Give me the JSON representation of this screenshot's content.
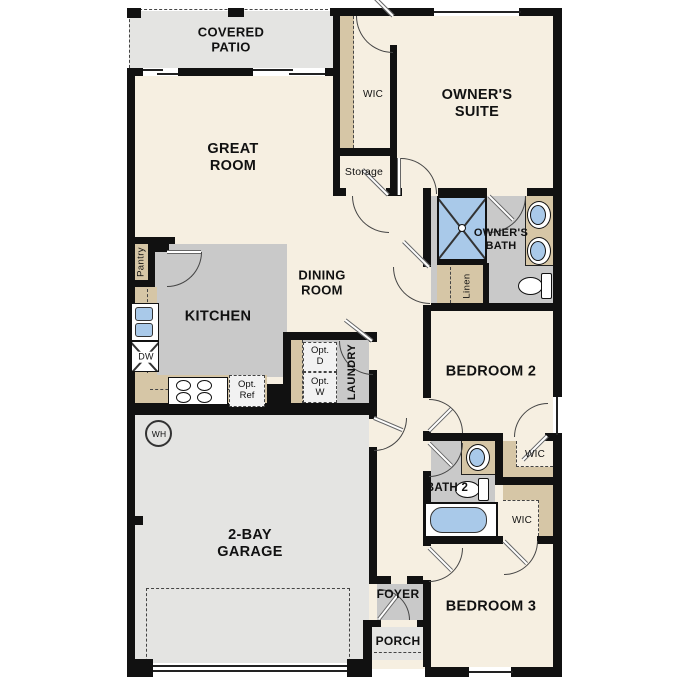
{
  "title": "Single-story floor plan",
  "colors": {
    "floor_cream": "#f6efe1",
    "floor_gray": "#c9c9c9",
    "floor_light": "#e4e4e2",
    "casework_tan": "#d6c6a6",
    "fixture_blue": "#a9c9e9",
    "wall": "#111111",
    "text": "#111111"
  },
  "rooms": {
    "covered_patio": "COVERED PATIO",
    "great_room": "GREAT ROOM",
    "owners_suite": "OWNER'S SUITE",
    "wic_owner": "WIC",
    "storage": "Storage",
    "dining_room": "DINING ROOM",
    "kitchen": "KITCHEN",
    "pantry": "Pantry",
    "owners_bath": "OWNER'S BATH",
    "linen": "Linen",
    "laundry": "LAUNDRY",
    "bedroom2": "BEDROOM 2",
    "wic_bedroom2": "WIC",
    "bath2": "BATH 2",
    "wic_bedroom3": "WIC",
    "bedroom3": "BEDROOM 3",
    "garage": "2-BAY GARAGE",
    "foyer": "FOYER",
    "porch": "PORCH"
  },
  "fixtures": {
    "dishwasher": "DW",
    "water_heater": "WH",
    "opt_dryer": {
      "l1": "Opt.",
      "l2": "D"
    },
    "opt_washer": {
      "l1": "Opt.",
      "l2": "W"
    },
    "opt_refrigerator": {
      "l1": "Opt.",
      "l2": "Ref"
    }
  }
}
